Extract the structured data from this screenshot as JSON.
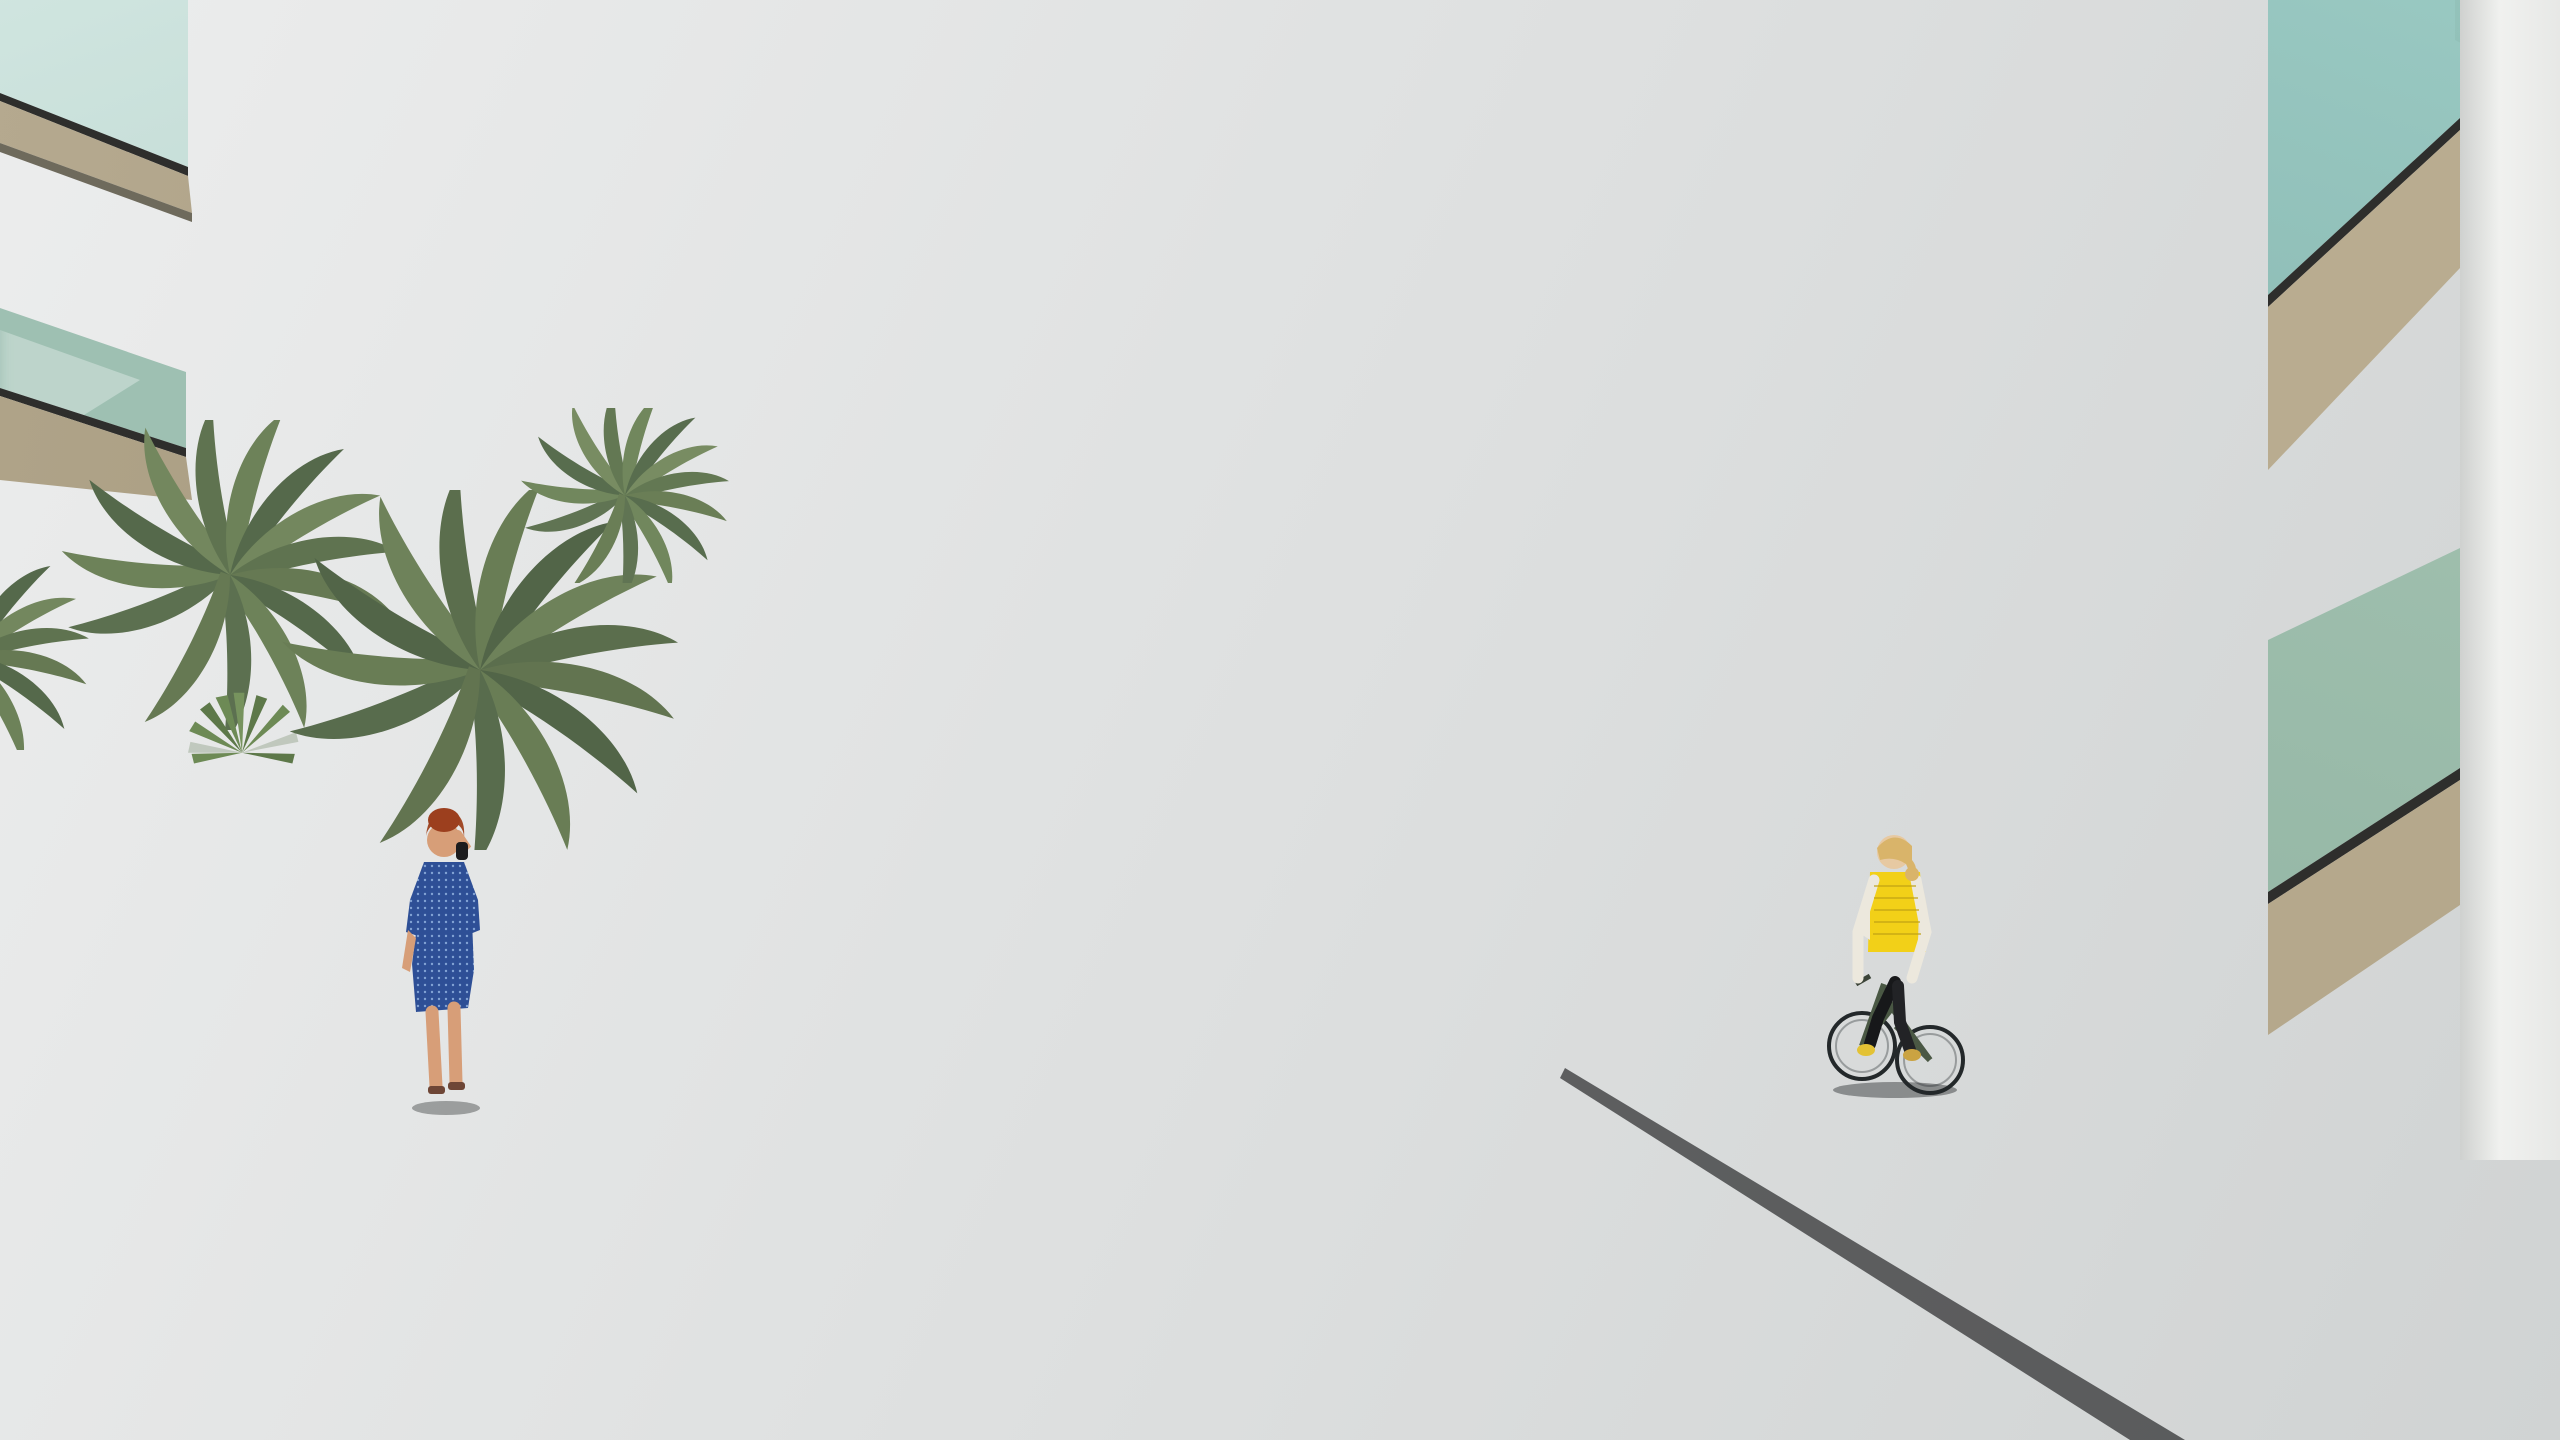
{
  "scene": {
    "title": "Residential complex entrance street - 3D architectural rendering",
    "type": "3d-architectural-visualization",
    "setting": "Modern white Mediterranean apartment block with wood accents behind a palm-lined access road, underground garage ramp, crosswalk and flanking walkways",
    "sky": {
      "top_color": "#3c86cb",
      "mid_color": "#8ebde4",
      "horizon_color": "#e9eff2",
      "clouds": "thin wispy cirrus streaks"
    },
    "building": {
      "floors": 3,
      "style": "white render with travertine wood bands, diagonal louver pergolas on roof floor, glass balconies",
      "features": [
        "roof terraces with parasols",
        "black chimney caps",
        "stair bulkheads",
        "wood pergola balconies",
        "beige balcony rails",
        "underground garage ramp"
      ],
      "accent_wood_color": "#c0965f",
      "white_color": "#f5f6f4",
      "balcony_glass_color": "#8fb7ab"
    },
    "road": {
      "surface": "dark asphalt",
      "surface_color": "#232327",
      "markings": [
        {
          "type": "lane-arrow",
          "direction": "down-left",
          "color": "#f5f5f3"
        },
        {
          "type": "lane-arrow",
          "direction": "up",
          "color": "#f5f5f3"
        },
        {
          "type": "crosswalk",
          "stripes": 6,
          "color": "#eef0ee"
        },
        {
          "type": "mini-ramp-arrows",
          "count": 2
        }
      ]
    },
    "vehicles": [
      {
        "type": "suv",
        "color": "#33519e",
        "position": "emerging from underground garage ramp",
        "view": "front"
      }
    ],
    "people": [
      {
        "id": "woman-blue-dress",
        "desc": "red-haired woman in blue polka-dot dress walking away on left walkway talking on phone"
      },
      {
        "id": "cyclist-yellow-vest",
        "desc": "blonde woman in yellow puffer vest and black leggings riding dark green bicycle on right paver path"
      },
      {
        "id": "woman-pink-blazer",
        "desc": "blonde woman in magenta blazer with tan handbag walking left near planters"
      },
      {
        "id": "man-white-tshirt",
        "desc": "man in white t-shirt and grey trousers walking away on left garden path"
      },
      {
        "id": "woman-dark-top",
        "desc": "woman in dark top standing by garage-side wall"
      },
      {
        "id": "woman-on-bike-group",
        "desc": "woman in olive top pushing bike near racks"
      },
      {
        "id": "boy-olive-jacket",
        "desc": "boy in olive jacket standing with mother"
      },
      {
        "id": "woman-floral-top",
        "desc": "woman in floral top and jeans touching boy's head"
      },
      {
        "id": "woman-stroller",
        "desc": "woman with stroller behind the group"
      },
      {
        "id": "balcony-couple",
        "desc": "couple standing on right-wing balcony"
      },
      {
        "id": "balcony-woman",
        "desc": "woman in white on central balcony"
      },
      {
        "id": "sunbather",
        "desc": "shirtless man seated behind left fence near pool umbrellas"
      }
    ],
    "vegetation": {
      "palm_trees": 10,
      "leafy_trees": 3,
      "shrubs": "dense green shrubs behind green mesh fences on both sides",
      "flowers": [
        "orange marigold drifts in planters",
        "pink flower spikes in right shrubs"
      ],
      "grass": "sunlit lawn strips beside left path"
    },
    "street_furniture": [
      "green wire-mesh fences with square posts",
      "dark shade sail over left garden",
      "white pool parasols",
      "rattan bench",
      "bike racks",
      "white low ramp walls"
    ],
    "palette": {
      "asphalt": "#232327",
      "white_wall_lit": "#fafaf9",
      "white_wall_shade": "#c9cdcd",
      "paver_lit": "#9d988c",
      "paver_shade": "#54565b",
      "fence_green": "#1d4a33",
      "palm_green": "#6b7d55",
      "shrub_green": "#46603c",
      "grass_green": "#7f9e52",
      "wood_band": "#c0965f",
      "glass_teal": "#8fb7ab",
      "suv_blue": "#33519e",
      "vest_yellow": "#f2d018",
      "dress_blue": "#2e4f96",
      "blazer_pink": "#c23d77"
    },
    "chart_data": null
  }
}
